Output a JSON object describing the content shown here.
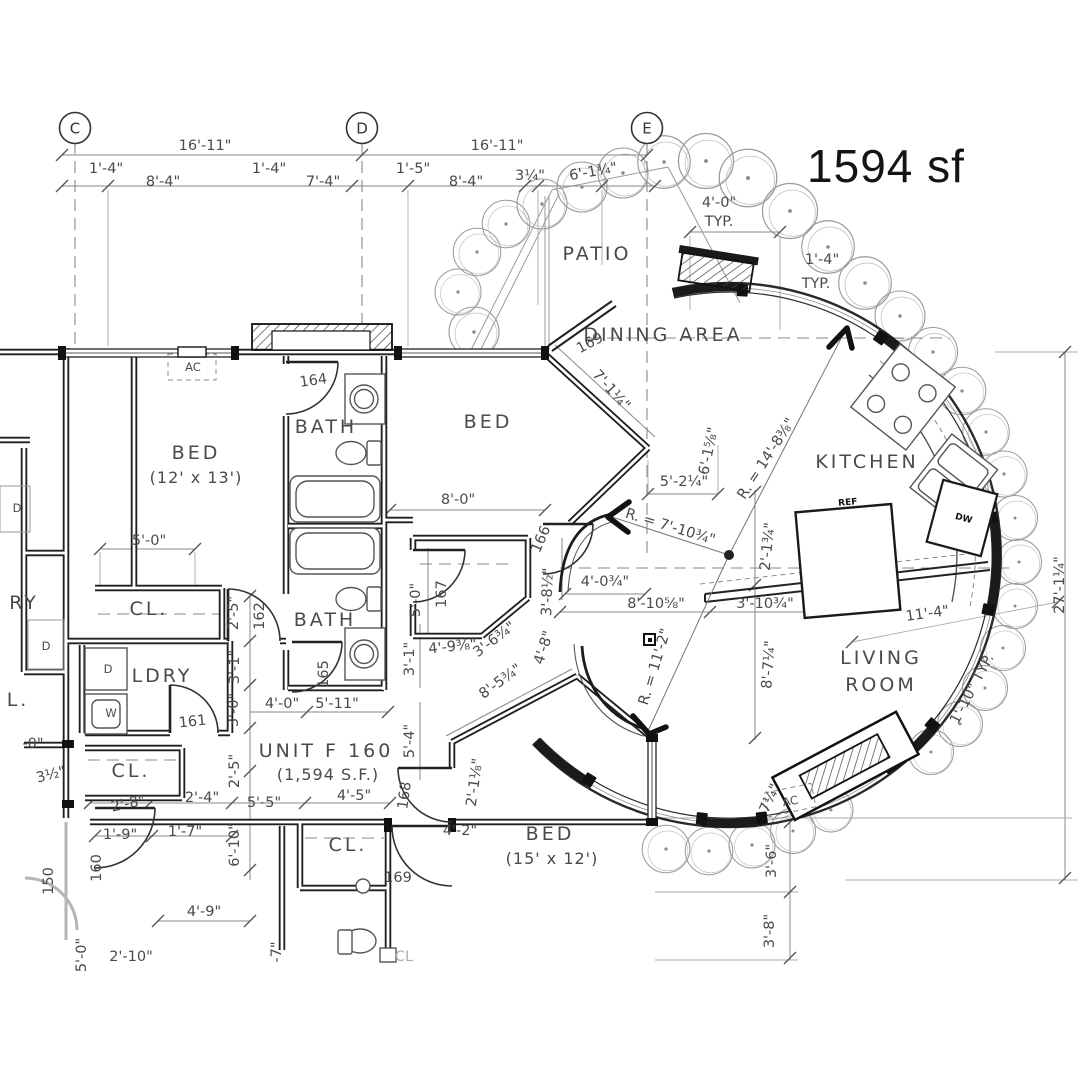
{
  "area": {
    "label": "1594 sf"
  },
  "unit": {
    "name": "UNIT F 160",
    "square_footage": "(1,594 S.F.)"
  },
  "colors": {
    "ink": "#4a4a4a",
    "wall": "#1f1f1f",
    "dim_line": "#8a8a8a",
    "shrub": "#9a9a9a",
    "area_text": "#141414"
  },
  "grid_markers": [
    {
      "label": "C",
      "x": 75,
      "y": 128
    },
    {
      "label": "D",
      "x": 362,
      "y": 128
    },
    {
      "label": "E",
      "x": 647,
      "y": 128
    }
  ],
  "annotations": [
    {
      "t": "PATIO",
      "x": 597,
      "y": 260,
      "c": "room"
    },
    {
      "t": "DINING AREA",
      "x": 663,
      "y": 341,
      "c": "room"
    },
    {
      "t": "KITCHEN",
      "x": 867,
      "y": 468,
      "c": "room"
    },
    {
      "t": "LIVING",
      "x": 881,
      "y": 664,
      "c": "room"
    },
    {
      "t": "ROOM",
      "x": 881,
      "y": 691,
      "c": "room"
    },
    {
      "t": "BED",
      "x": 488,
      "y": 428,
      "c": "room"
    },
    {
      "t": "BED",
      "x": 196,
      "y": 459,
      "c": "room"
    },
    {
      "t": "(12' x 13')",
      "x": 196,
      "y": 483,
      "c": "sub"
    },
    {
      "t": "BATH",
      "x": 326,
      "y": 433,
      "c": "room"
    },
    {
      "t": "BATH",
      "x": 325,
      "y": 626,
      "c": "room"
    },
    {
      "t": "LDRY",
      "x": 162,
      "y": 682,
      "c": "room"
    },
    {
      "t": "BED",
      "x": 550,
      "y": 840,
      "c": "room"
    },
    {
      "t": "(15' x 12')",
      "x": 552,
      "y": 864,
      "c": "sub"
    },
    {
      "t": "CL.",
      "x": 149,
      "y": 615,
      "c": "room"
    },
    {
      "t": "CL.",
      "x": 131,
      "y": 777,
      "c": "room"
    },
    {
      "t": "CL.",
      "x": 348,
      "y": 851,
      "c": "room"
    },
    {
      "t": "UNIT F 160",
      "x": 326,
      "y": 757,
      "c": "room"
    },
    {
      "t": "(1,594 S.F.)",
      "x": 328,
      "y": 780,
      "c": "sub"
    },
    {
      "t": "RY",
      "x": 24,
      "y": 609,
      "c": "room"
    },
    {
      "t": "L.",
      "x": 18,
      "y": 706,
      "c": "room"
    },
    {
      "t": "CL",
      "x": 404,
      "y": 961,
      "c": "fade"
    },
    {
      "t": "16'-11\"",
      "x": 205,
      "y": 150,
      "c": "dim"
    },
    {
      "t": "16'-11\"",
      "x": 497,
      "y": 150,
      "c": "dim"
    },
    {
      "t": "1'-4\"",
      "x": 106,
      "y": 173,
      "c": "dim"
    },
    {
      "t": "8'-4\"",
      "x": 163,
      "y": 186,
      "c": "dim"
    },
    {
      "t": "1'-4\"",
      "x": 269,
      "y": 173,
      "c": "dim"
    },
    {
      "t": "7'-4\"",
      "x": 323,
      "y": 186,
      "c": "dim"
    },
    {
      "t": "1'-5\"",
      "x": 413,
      "y": 173,
      "c": "dim"
    },
    {
      "t": "8'-4\"",
      "x": 466,
      "y": 186,
      "c": "dim"
    },
    {
      "t": "3¼\"",
      "x": 530,
      "y": 180,
      "c": "dim"
    },
    {
      "t": "6'-1¾\"",
      "x": 594,
      "y": 176,
      "c": "dim",
      "r": -10
    },
    {
      "t": "4'-0\"",
      "x": 719,
      "y": 207,
      "c": "dim"
    },
    {
      "t": "TYP.",
      "x": 719,
      "y": 226,
      "c": "dim"
    },
    {
      "t": "1'-4\"",
      "x": 822,
      "y": 264,
      "c": "dim"
    },
    {
      "t": "TYP.",
      "x": 816,
      "y": 288,
      "c": "dim"
    },
    {
      "t": "7'-1¼\"",
      "x": 608,
      "y": 393,
      "c": "dim",
      "r": 48
    },
    {
      "t": "R. = 14'-8⅜\"",
      "x": 770,
      "y": 461,
      "c": "dim",
      "r": -57
    },
    {
      "t": "6'-1⅝\"",
      "x": 713,
      "y": 452,
      "c": "dim",
      "r": -78
    },
    {
      "t": "5'-2¼\"",
      "x": 684,
      "y": 486,
      "c": "dim"
    },
    {
      "t": "R. = 7'-10¾\"",
      "x": 669,
      "y": 531,
      "c": "dim",
      "r": 17
    },
    {
      "t": "2'-1¾\"",
      "x": 772,
      "y": 547,
      "c": "dim",
      "r": -84
    },
    {
      "t": "4'-0¾\"",
      "x": 605,
      "y": 586,
      "c": "dim"
    },
    {
      "t": "8'-10⅝\"",
      "x": 656,
      "y": 608,
      "c": "dim"
    },
    {
      "t": "3'-10¾\"",
      "x": 765,
      "y": 608,
      "c": "dim"
    },
    {
      "t": "11'-4\"",
      "x": 928,
      "y": 618,
      "c": "dim",
      "r": -8
    },
    {
      "t": "R. = 11'-2\"",
      "x": 659,
      "y": 668,
      "c": "dim",
      "r": -73
    },
    {
      "t": "8'-7¼\"",
      "x": 773,
      "y": 665,
      "c": "dim",
      "r": -86
    },
    {
      "t": "8'-0\"",
      "x": 458,
      "y": 504,
      "c": "dim"
    },
    {
      "t": "5'-0\"",
      "x": 420,
      "y": 600,
      "c": "dim",
      "r": -90
    },
    {
      "t": "3'-8½\"",
      "x": 552,
      "y": 592,
      "c": "dim",
      "r": -88
    },
    {
      "t": "5'-0\"",
      "x": 149,
      "y": 545,
      "c": "dim"
    },
    {
      "t": "2'-5\"",
      "x": 238,
      "y": 613,
      "c": "dim",
      "r": -90
    },
    {
      "t": "3'-1\"",
      "x": 239,
      "y": 667,
      "c": "dim",
      "r": -90
    },
    {
      "t": "3'-0\"",
      "x": 238,
      "y": 710,
      "c": "dim",
      "r": -90
    },
    {
      "t": "2'-5\"",
      "x": 239,
      "y": 771,
      "c": "dim",
      "r": -90
    },
    {
      "t": "6'-10\"",
      "x": 239,
      "y": 845,
      "c": "dim",
      "r": -90
    },
    {
      "t": "4'-0\"",
      "x": 282,
      "y": 708,
      "c": "dim"
    },
    {
      "t": "5'-11\"",
      "x": 337,
      "y": 708,
      "c": "dim"
    },
    {
      "t": "3'-1\"",
      "x": 414,
      "y": 659,
      "c": "dim",
      "r": -90
    },
    {
      "t": "4'-9⅜\"",
      "x": 453,
      "y": 651,
      "c": "dim",
      "r": -6
    },
    {
      "t": "3'-6¾\"",
      "x": 497,
      "y": 643,
      "c": "dim",
      "r": -37
    },
    {
      "t": "4'-8\"",
      "x": 548,
      "y": 649,
      "c": "dim",
      "r": -72
    },
    {
      "t": "8'-5¾\"",
      "x": 503,
      "y": 685,
      "c": "dim",
      "r": -36
    },
    {
      "t": "5'-4\"",
      "x": 414,
      "y": 741,
      "c": "dim",
      "r": -90
    },
    {
      "t": "2'-1⅛\"",
      "x": 479,
      "y": 783,
      "c": "dim",
      "r": -82
    },
    {
      "t": "4'-5\"",
      "x": 354,
      "y": 800,
      "c": "dim"
    },
    {
      "t": "4'-2\"",
      "x": 460,
      "y": 835,
      "c": "dim"
    },
    {
      "t": "2'-8\"",
      "x": 129,
      "y": 808,
      "c": "dim",
      "r": -12
    },
    {
      "t": "2'-4\"",
      "x": 202,
      "y": 802,
      "c": "dim"
    },
    {
      "t": "5'-5\"",
      "x": 264,
      "y": 807,
      "c": "dim"
    },
    {
      "t": "3½\"",
      "x": 52,
      "y": 779,
      "c": "dim",
      "r": -14
    },
    {
      "t": "-0\"",
      "x": 33,
      "y": 748,
      "c": "dim"
    },
    {
      "t": "1'-9\"",
      "x": 120,
      "y": 839,
      "c": "dim"
    },
    {
      "t": "1'-7\"",
      "x": 185,
      "y": 836,
      "c": "dim"
    },
    {
      "t": "4'-9\"",
      "x": 204,
      "y": 916,
      "c": "dim"
    },
    {
      "t": "2'-10\"",
      "x": 131,
      "y": 961,
      "c": "dim"
    },
    {
      "t": "5'-0\"",
      "x": 86,
      "y": 955,
      "c": "dim",
      "r": -90
    },
    {
      "t": "-7\"",
      "x": 281,
      "y": 952,
      "c": "dim",
      "r": -90
    },
    {
      "t": "3'-6\"",
      "x": 776,
      "y": 861,
      "c": "dim",
      "r": -90
    },
    {
      "t": "3'-8\"",
      "x": 774,
      "y": 931,
      "c": "dim",
      "r": -90
    },
    {
      "t": "27'-1¼\"",
      "x": 1064,
      "y": 585,
      "c": "dim",
      "r": -90
    },
    {
      "t": "1'-10\" TYP.",
      "x": 976,
      "y": 691,
      "c": "dim",
      "r": -62
    },
    {
      "t": "7¼\"",
      "x": 774,
      "y": 800,
      "c": "dim",
      "r": -66
    },
    {
      "t": "164",
      "x": 314,
      "y": 385,
      "c": "tag",
      "r": -8
    },
    {
      "t": "162",
      "x": 264,
      "y": 616,
      "c": "tag",
      "r": -90
    },
    {
      "t": "165",
      "x": 328,
      "y": 674,
      "c": "tag",
      "r": -90
    },
    {
      "t": "161",
      "x": 193,
      "y": 726,
      "c": "tag",
      "r": -6
    },
    {
      "t": "167",
      "x": 446,
      "y": 594,
      "c": "tag",
      "r": -90
    },
    {
      "t": "166",
      "x": 545,
      "y": 541,
      "c": "tag",
      "r": -66
    },
    {
      "t": "168",
      "x": 409,
      "y": 796,
      "c": "tag",
      "r": -82
    },
    {
      "t": "169",
      "x": 592,
      "y": 347,
      "c": "tag",
      "r": -28
    },
    {
      "t": "169",
      "x": 398,
      "y": 882,
      "c": "tag"
    },
    {
      "t": "160",
      "x": 101,
      "y": 868,
      "c": "tag",
      "r": -90
    },
    {
      "t": "150",
      "x": 53,
      "y": 881,
      "c": "tag",
      "r": -90
    },
    {
      "t": "AC",
      "x": 193,
      "y": 371,
      "c": "sm"
    },
    {
      "t": "AC",
      "x": 791,
      "y": 805,
      "c": "sm",
      "r": -10
    },
    {
      "t": "D",
      "x": 46,
      "y": 650,
      "c": "sm"
    },
    {
      "t": "D",
      "x": 108,
      "y": 673,
      "c": "sm"
    },
    {
      "t": "W",
      "x": 111,
      "y": 717,
      "c": "sm"
    },
    {
      "t": "D",
      "x": 17,
      "y": 512,
      "c": "sm"
    },
    {
      "t": "REF",
      "x": 848,
      "y": 505,
      "c": "tiny",
      "r": -5
    },
    {
      "t": "DW",
      "x": 963,
      "y": 521,
      "c": "tiny",
      "r": 15
    }
  ]
}
